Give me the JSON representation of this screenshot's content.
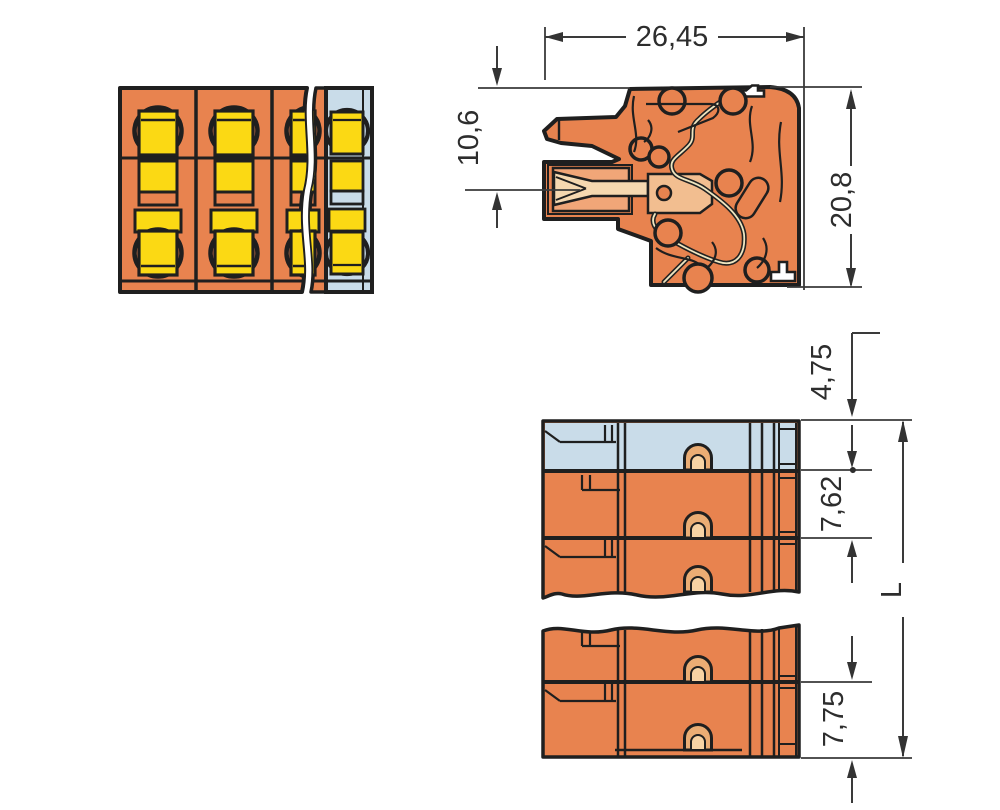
{
  "drawing": {
    "kind": "terminal-block-connector-dimension-drawing",
    "views": {
      "front": "multi-pole front view with break",
      "side": "cross-section side view",
      "bottom": "bottom view with break"
    }
  },
  "dimensions": {
    "overall_width": "26,45",
    "entry_height": "10,6",
    "overall_height": "20,8",
    "end_offset": "4,75",
    "pole_pitch": "7,62",
    "pole_pitch_marker": "●",
    "end_pole_height": "7,75",
    "overall_length": "L"
  },
  "colors": {
    "background": "#ffffff",
    "outline": "#1f1f1f",
    "body_orange": "#E8834F",
    "cavity_orange": "#F1A678",
    "metal_beige": "#F5D8B0",
    "plate_tan": "#F2BE90",
    "contact_yellow": "#FBD914",
    "end_module_blue": "#C9DCE9",
    "notch_tan": "#EBAD74",
    "notch_inner": "#F7D3A4",
    "dimension_gray": "#3a3a3a"
  }
}
